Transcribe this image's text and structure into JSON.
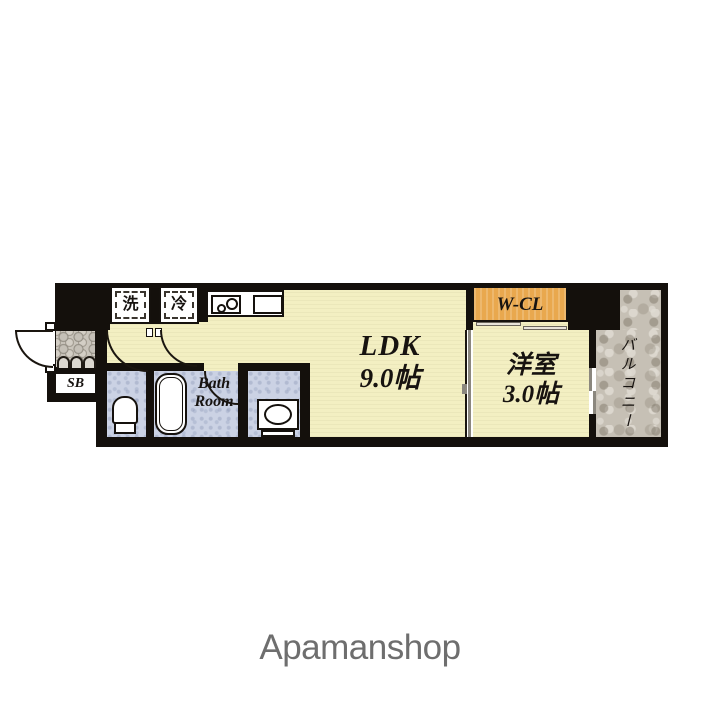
{
  "brand": {
    "name": "Apamanshop"
  },
  "floorplan": {
    "rooms": {
      "ldk": {
        "label": "LDK",
        "size": "9.0帖"
      },
      "western_room": {
        "label": "洋室",
        "size": "3.0帖"
      },
      "walk_in_closet": {
        "label": "W-CL"
      },
      "balcony": {
        "label": "バルコニー"
      },
      "bathroom": {
        "label_line1": "Bath",
        "label_line2": "Room"
      },
      "shoe_box": {
        "label": "SB"
      },
      "washer_space": {
        "label": "洗"
      },
      "fridge_space": {
        "label": "冷"
      }
    },
    "colors": {
      "room_beige": "#f3efc2",
      "closet_orange": "#e9a84e",
      "balcony_gray": "#c6c0b5",
      "wet_blue": "#cbd2e4",
      "wall_black": "#14100c",
      "brand_gray": "#6e6e6e"
    }
  }
}
